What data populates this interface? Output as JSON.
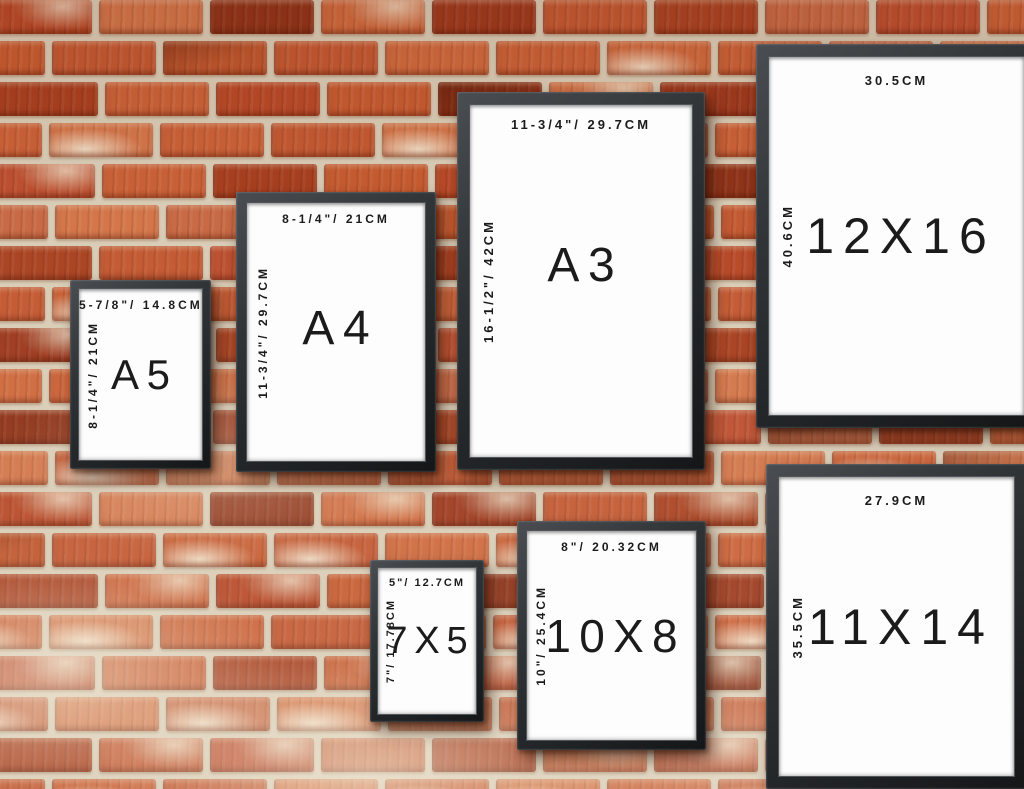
{
  "scene": "picture-frame-size-comparison-on-brick-wall",
  "frames": [
    {
      "name": "A5",
      "size_label": "A5",
      "width_label": "5-7/8\"/ 14.8CM",
      "height_label": "8-1/4\"/ 21CM"
    },
    {
      "name": "A4",
      "size_label": "A4",
      "width_label": "8-1/4\"/ 21CM",
      "height_label": "11-3/4\"/ 29.7CM"
    },
    {
      "name": "A3",
      "size_label": "A3",
      "width_label": "11-3/4\"/ 29.7CM",
      "height_label": "16-1/2\"/ 42CM"
    },
    {
      "name": "12X16",
      "size_label": "12X16",
      "width_label": "30.5CM",
      "height_label": "40.6CM"
    },
    {
      "name": "7X5",
      "size_label": "7X5",
      "width_label": "5\"/ 12.7CM",
      "height_label": "7\"/ 17.78CM"
    },
    {
      "name": "10X8",
      "size_label": "10X8",
      "width_label": "8\"/ 20.32CM",
      "height_label": "10\"/ 25.4CM"
    },
    {
      "name": "11X14",
      "size_label": "11X14",
      "width_label": "27.9CM",
      "height_label": "35.5CM"
    }
  ],
  "colors": {
    "mortar": "#d9cdb7",
    "brick_palette": [
      "#b84a28",
      "#c35a33",
      "#a84020",
      "#cf6a3e",
      "#bd5030",
      "#d3764a",
      "#aa4423",
      "#c65c31",
      "#9d3a1e",
      "#ca6238",
      "#8f3419",
      "#c86a45"
    ],
    "frame": "#26292c",
    "paper": "#fdfdfd",
    "text": "#1b1b1b"
  },
  "wall": {
    "rows": 20,
    "bricks_per_row": 11
  }
}
